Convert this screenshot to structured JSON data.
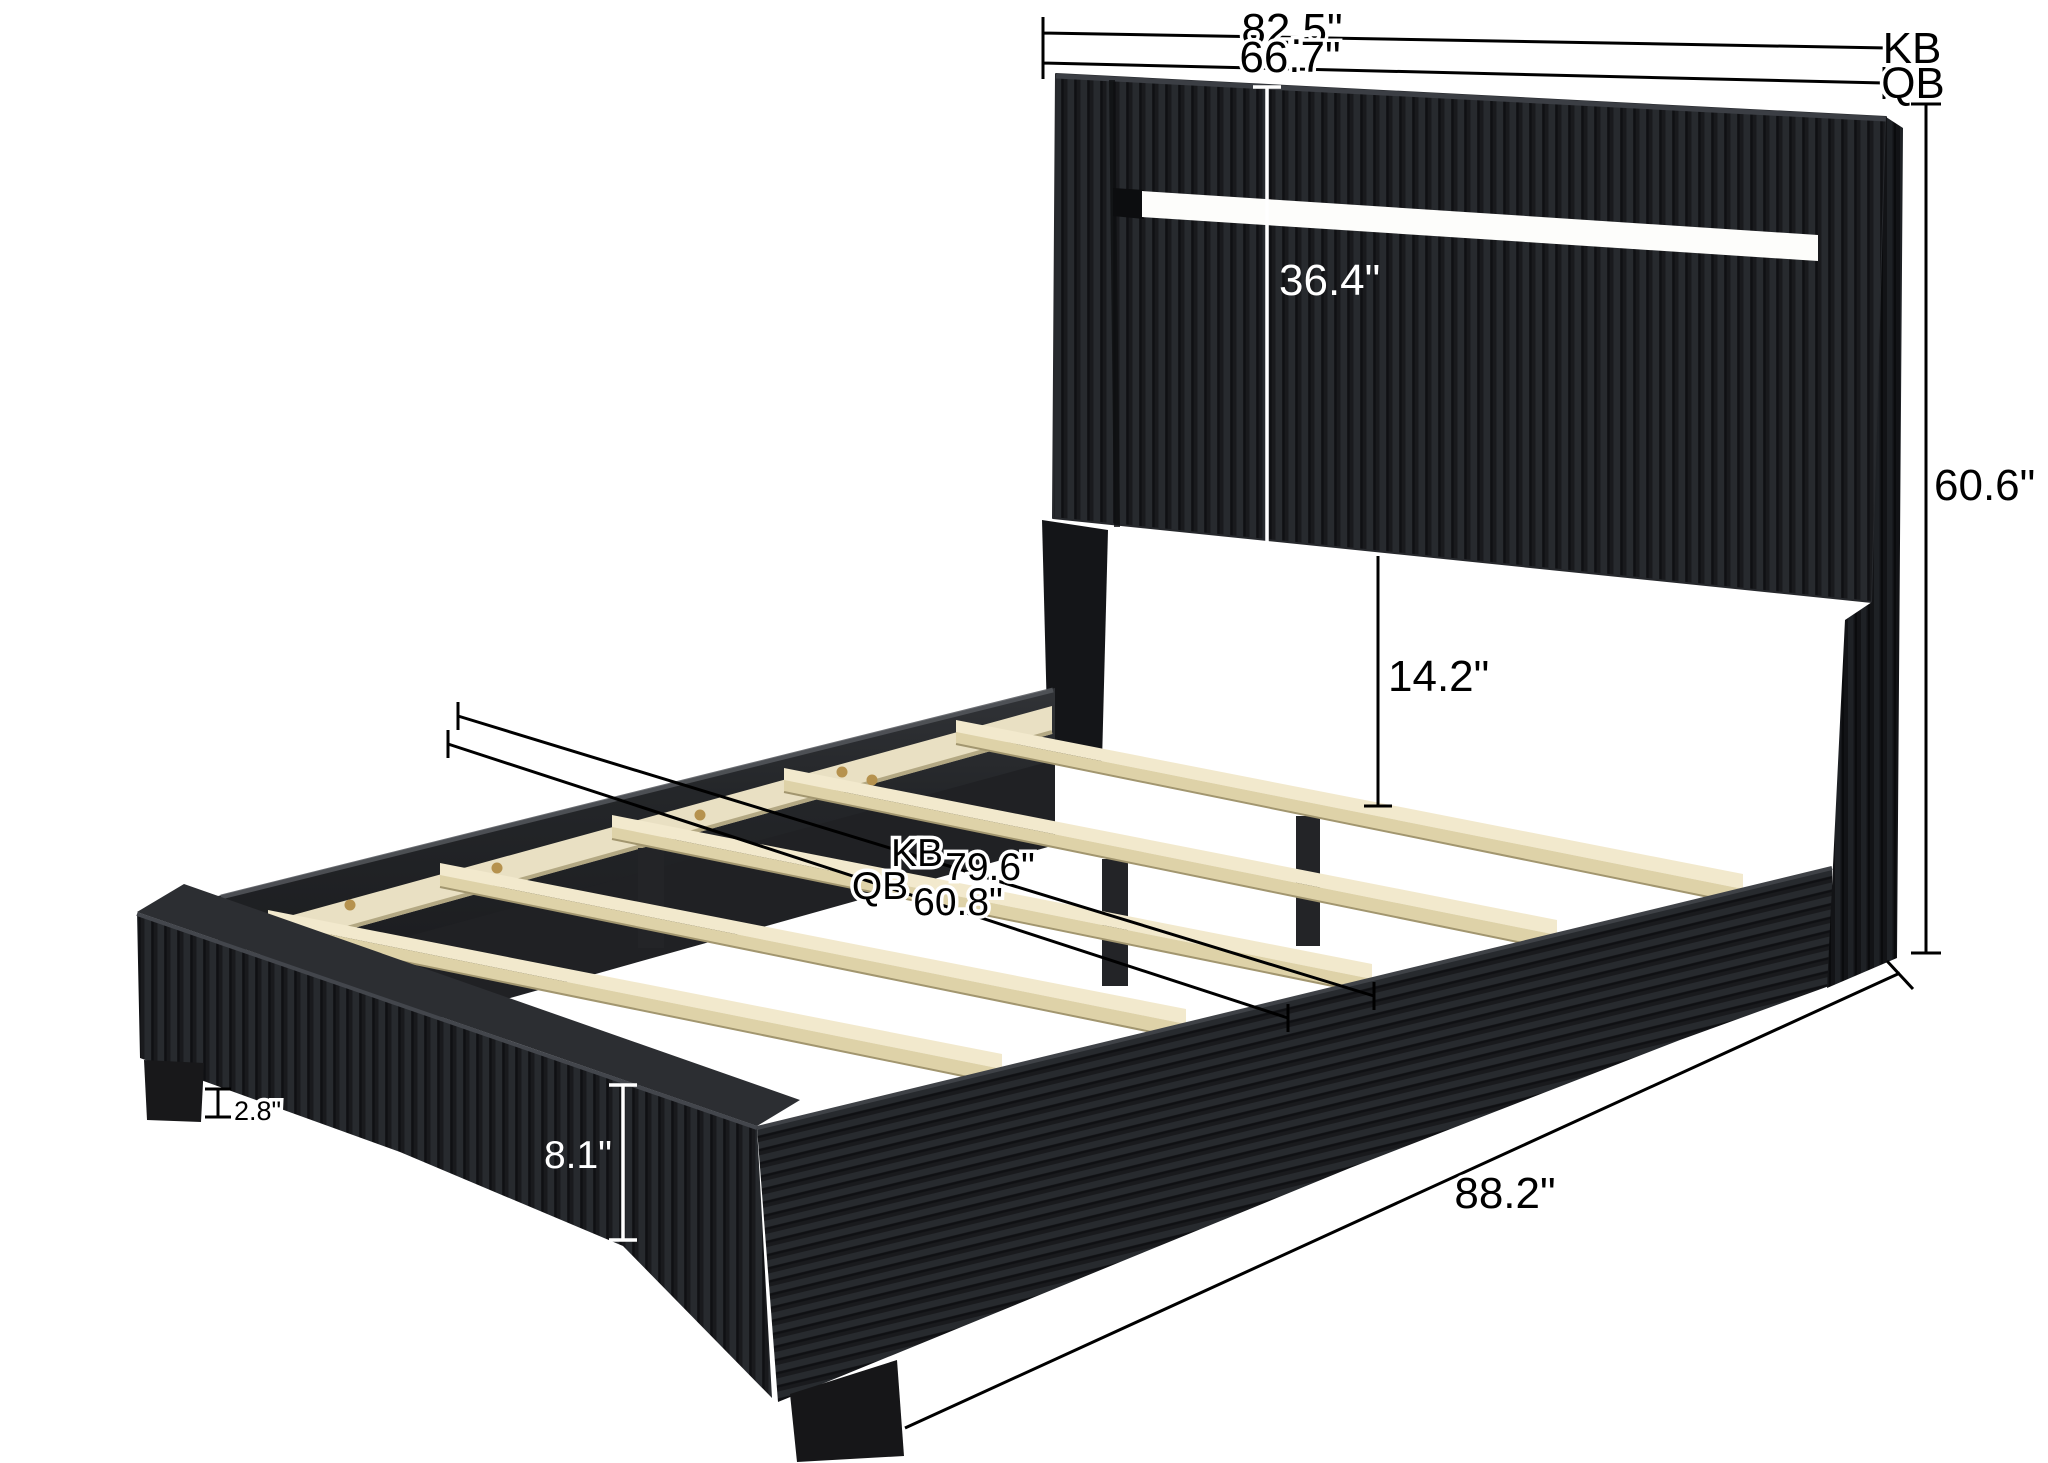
{
  "diagram": {
    "title": "upholstered-platform-bed-dimension-diagram",
    "units": "inches",
    "size_labels": {
      "king": "KB",
      "queen": "QB"
    },
    "dimensions": {
      "width_king": "82.5\"",
      "width_queen": "66.7\"",
      "headboard_panel_height": "36.4\"",
      "headboard_to_slat_gap": "14.2\"",
      "overall_height": "60.6\"",
      "interior_length_king": "79.6\"",
      "interior_length_queen": "60.8\"",
      "overall_length": "88.2\"",
      "side_rail_height": "8.1\"",
      "leg_height": "2.8\""
    },
    "colors": {
      "background": "#ffffff",
      "fabric_dark": "#1e2023",
      "led_strip": "#fdfdfb",
      "slat_wood": "#f2e9cd",
      "slat_wood_edge": "#ded2a8",
      "screw_gold": "#b6924e",
      "dimension_line": "#000000"
    }
  }
}
